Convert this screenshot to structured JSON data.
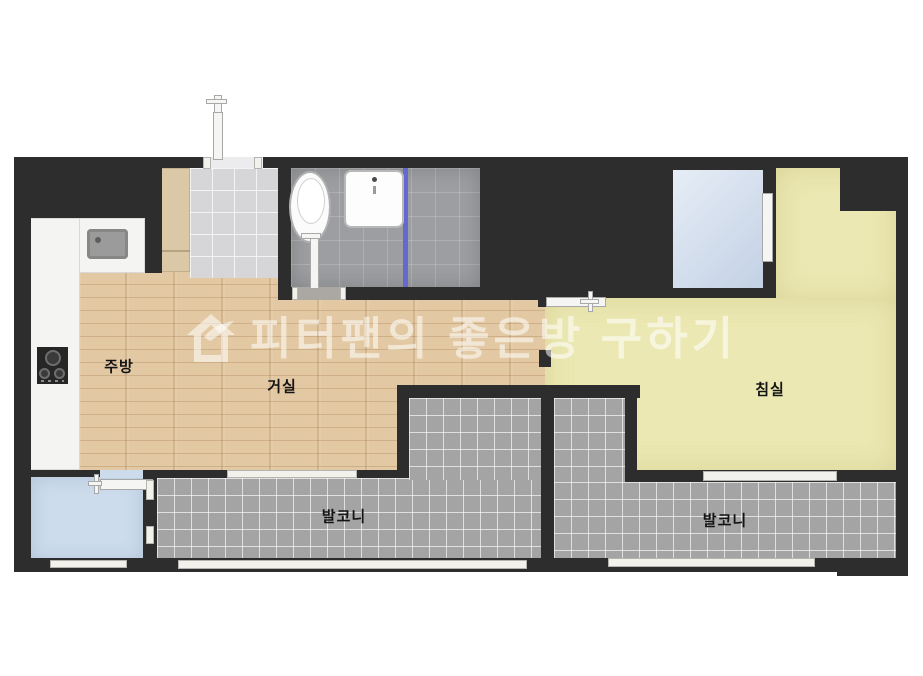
{
  "watermark": {
    "text": "피터팬의 좋은방 구하기",
    "icon": "house-with-swoosh-logo"
  },
  "rooms": {
    "kitchen": {
      "label": "주방"
    },
    "living_room": {
      "label": "거실"
    },
    "bedroom": {
      "label": "침실"
    },
    "balcony_left": {
      "label": "발코니"
    },
    "balcony_right": {
      "label": "발코니"
    }
  },
  "icons": {
    "logo": "house-with-swoosh",
    "stove": "cooktop-three-burners",
    "toilet": "toilet-top-view",
    "washbasin": "washbasin-top-view",
    "kitchen_sink": "kitchen-sink-top-view"
  },
  "colors": {
    "wall": "#2e2d2d",
    "wood_floor": "#e3c9a3",
    "bedroom_floor": "#ece8b3",
    "balcony_tile": "#a4a4a4",
    "bathroom_tile": "#9c9ea1",
    "entry_tile": "#d6d6d8",
    "closet_fill": "#cfdbea",
    "utility_fill": "#ccdcec",
    "counter": "#f4f4f2",
    "cabinet": "#dbc8a6",
    "shower_divider": "#6468cf",
    "watermark_text": "rgba(255,255,255,0.55)"
  }
}
